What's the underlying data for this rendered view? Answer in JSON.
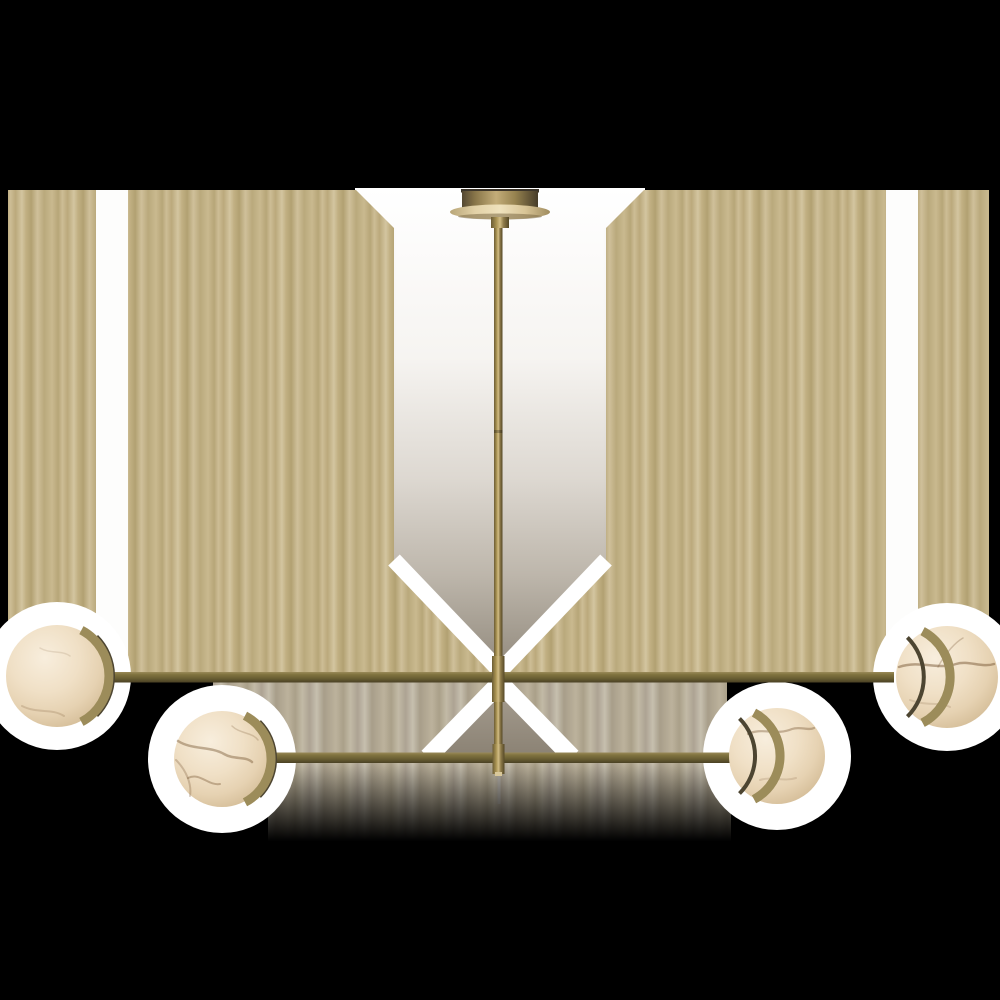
{
  "image": {
    "description": "Product photo of a two-tier linear brass chandelier with four alabaster globe shades, shown on a black background with tan and white masked panels",
    "type": "product-photograph",
    "fixture": "linear chandelier",
    "finish": "antique brass",
    "shade_material": "alabaster"
  },
  "parts": {
    "canopy": "ceiling canopy",
    "stem": "center down-rod",
    "upper_arm": "long upper cross arm",
    "lower_arm": "short lower cross arm",
    "globe_upper_left": "upper left alabaster globe",
    "globe_upper_right": "upper right alabaster globe",
    "globe_lower_left": "lower left alabaster globe",
    "globe_lower_right": "lower right alabaster globe"
  },
  "colors": {
    "background": "#000000",
    "halo_white": "#ffffff",
    "gap_white": "#fdfdfc",
    "column_top": "#ffffff",
    "column_bottom": "#91897c",
    "tan_stripe_light": "#d3c5a0",
    "tan_stripe_mid": "#c1b083",
    "tan_stripe_dark": "#b2a172",
    "gray_stripe_light": "#c6bfae",
    "gray_stripe_dark": "#a89e8a",
    "junction_taupe": "#9e9588",
    "brass_dark": "#4a4124",
    "brass_mid": "#80733f",
    "brass_light": "#c9b57e",
    "rod_highlight": "#d2bd85",
    "canopy_light": "#efe2bd",
    "canopy_edge": "#3c352a",
    "globe_cream": "#f8eedd",
    "globe_rim": "#c2a87f",
    "vein_brown": "#7a5a38",
    "fitter_brass": "#9c8c5a",
    "fitter_dark": "#4d4531",
    "stub_tip": "#d9c89a",
    "shadow_line": "#b9b5ae"
  },
  "geometry": {
    "canvas": {
      "width": 1000,
      "height": 1000
    },
    "content_band": {
      "top": 188,
      "bottom": 792
    },
    "upper_arm_y": 672,
    "lower_arm_y": 753,
    "globe_centers": [
      [
        57,
        676
      ],
      [
        947,
        677
      ],
      [
        222,
        759
      ],
      [
        777,
        756
      ]
    ],
    "globe_radius": 50
  }
}
